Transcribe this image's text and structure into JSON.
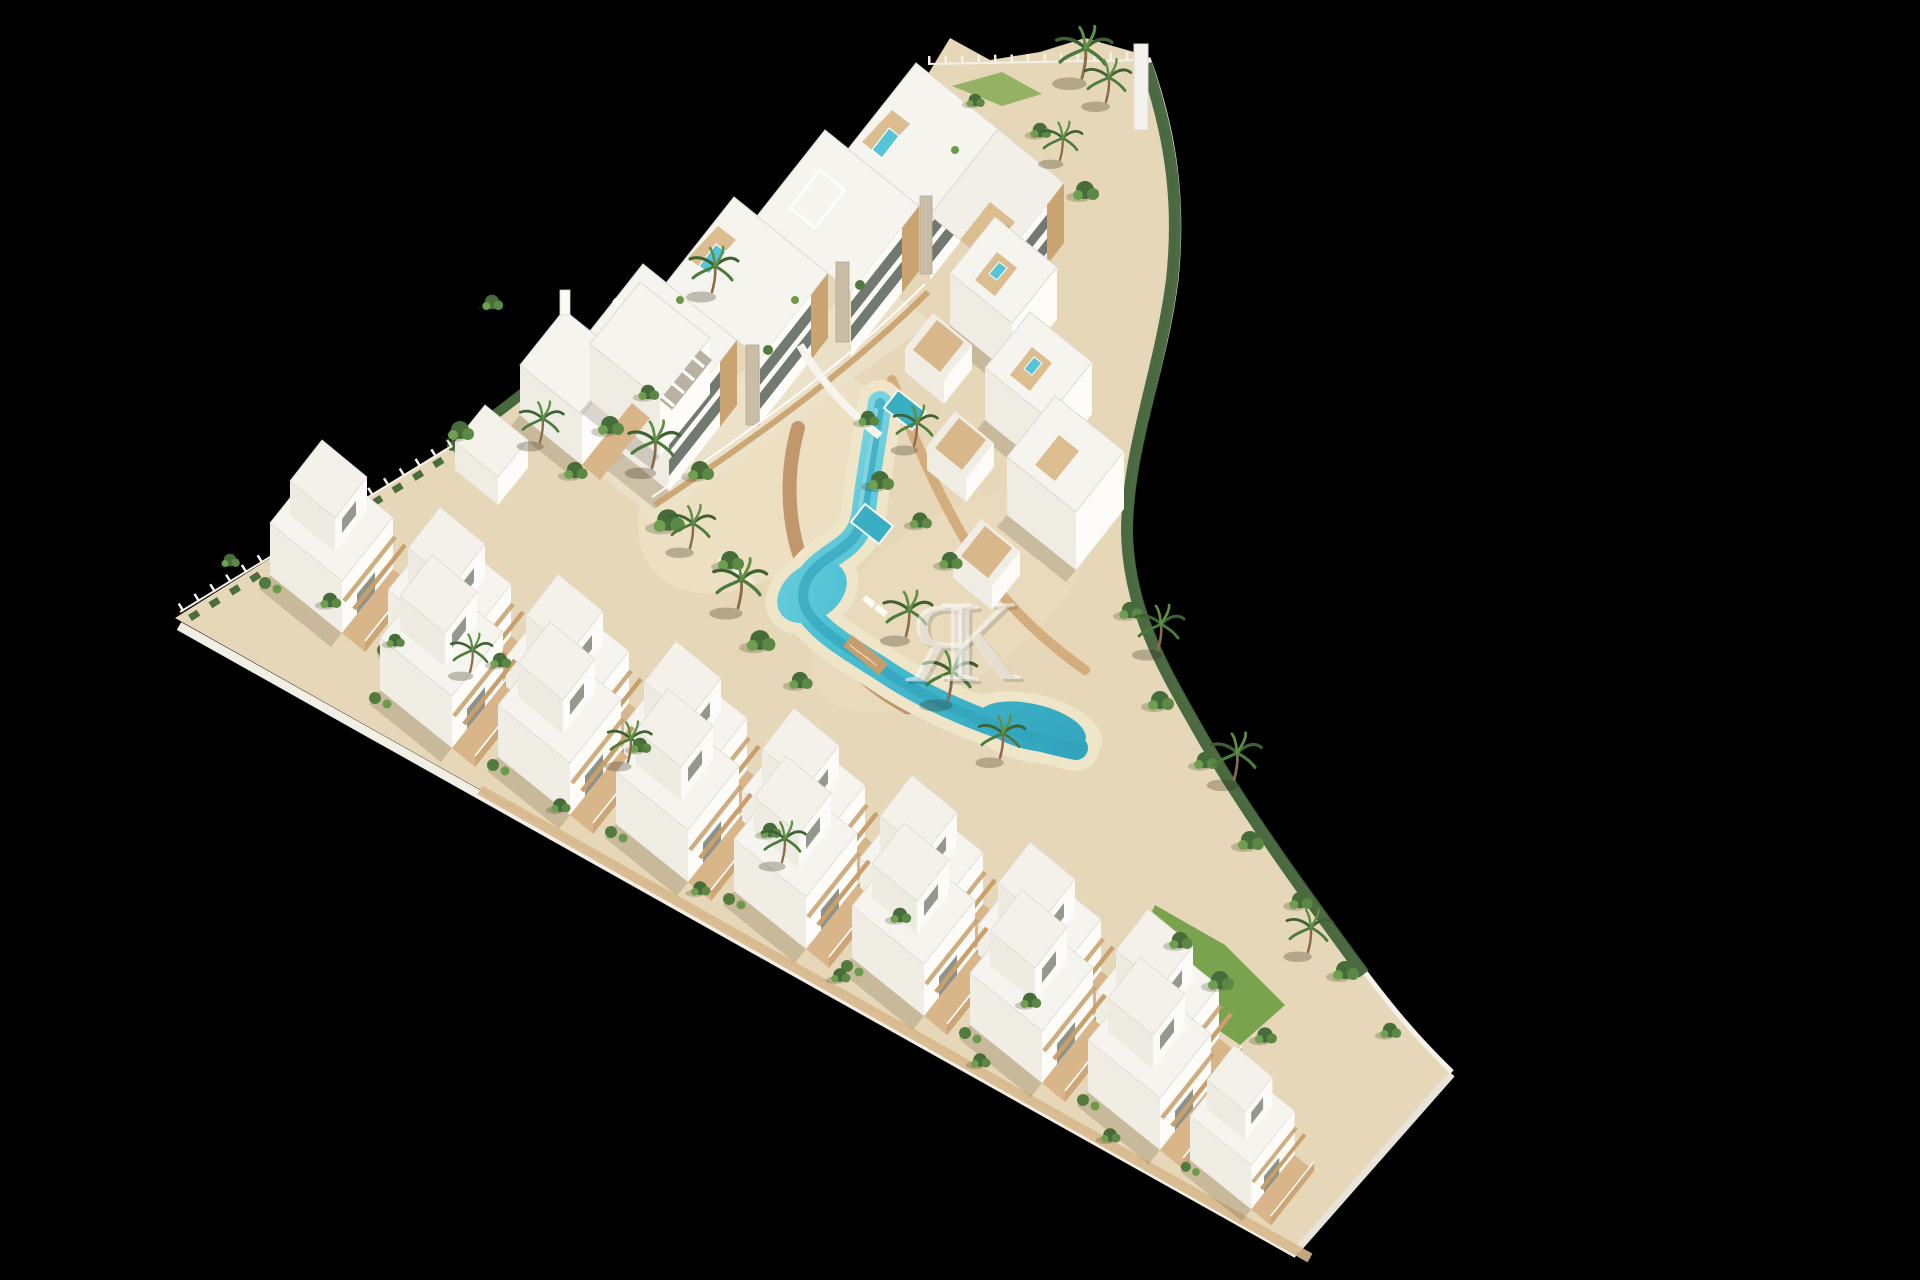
{
  "meta": {
    "kind": "architectural-3d-render",
    "view": "aerial-isometric",
    "subject": "triangular coastal residential development with lagoon pool",
    "canvas": {
      "width": 1920,
      "height": 1280
    }
  },
  "watermark": {
    "letter1": "Я",
    "letter2": "K",
    "color": "#ffffff",
    "opacity": 0.52
  },
  "palette": {
    "background": "#000000",
    "sand": "#e6d7b8",
    "sand_light": "#efe5c9",
    "plaza": "#ece3cb",
    "roof_white": "#f6f4ee",
    "wall_bright": "#fdfcf9",
    "wall_shaded": "#f0ede5",
    "wall_dark": "#e6e2d8",
    "wood": "#d8b689",
    "wood_dark": "#c9a06c",
    "brick_path": "#bf8f63",
    "pool_turquoise": "#4cbfd3",
    "pool_deep": "#2fa3bc",
    "pool_pale": "#aee8ec",
    "hedge_green": "#45683c",
    "palm_green": "#3d6132",
    "leaf_light": "#5f8f46",
    "lawn": "#7aa34e",
    "stone": "#c9bda6",
    "glass": "#636a61",
    "fence_white": "#f3f1ea"
  },
  "scene": {
    "site_shape": "triangle",
    "apartment_block_segments": 4,
    "townhouses_upper_row": 8,
    "townhouses_lower_row": 8,
    "hillside_villas": 3,
    "rooftop_pools": 4,
    "private_pools": 2,
    "main_pool": "winding lagoon with two basins and wooden bridge",
    "palm_trees": 18
  }
}
